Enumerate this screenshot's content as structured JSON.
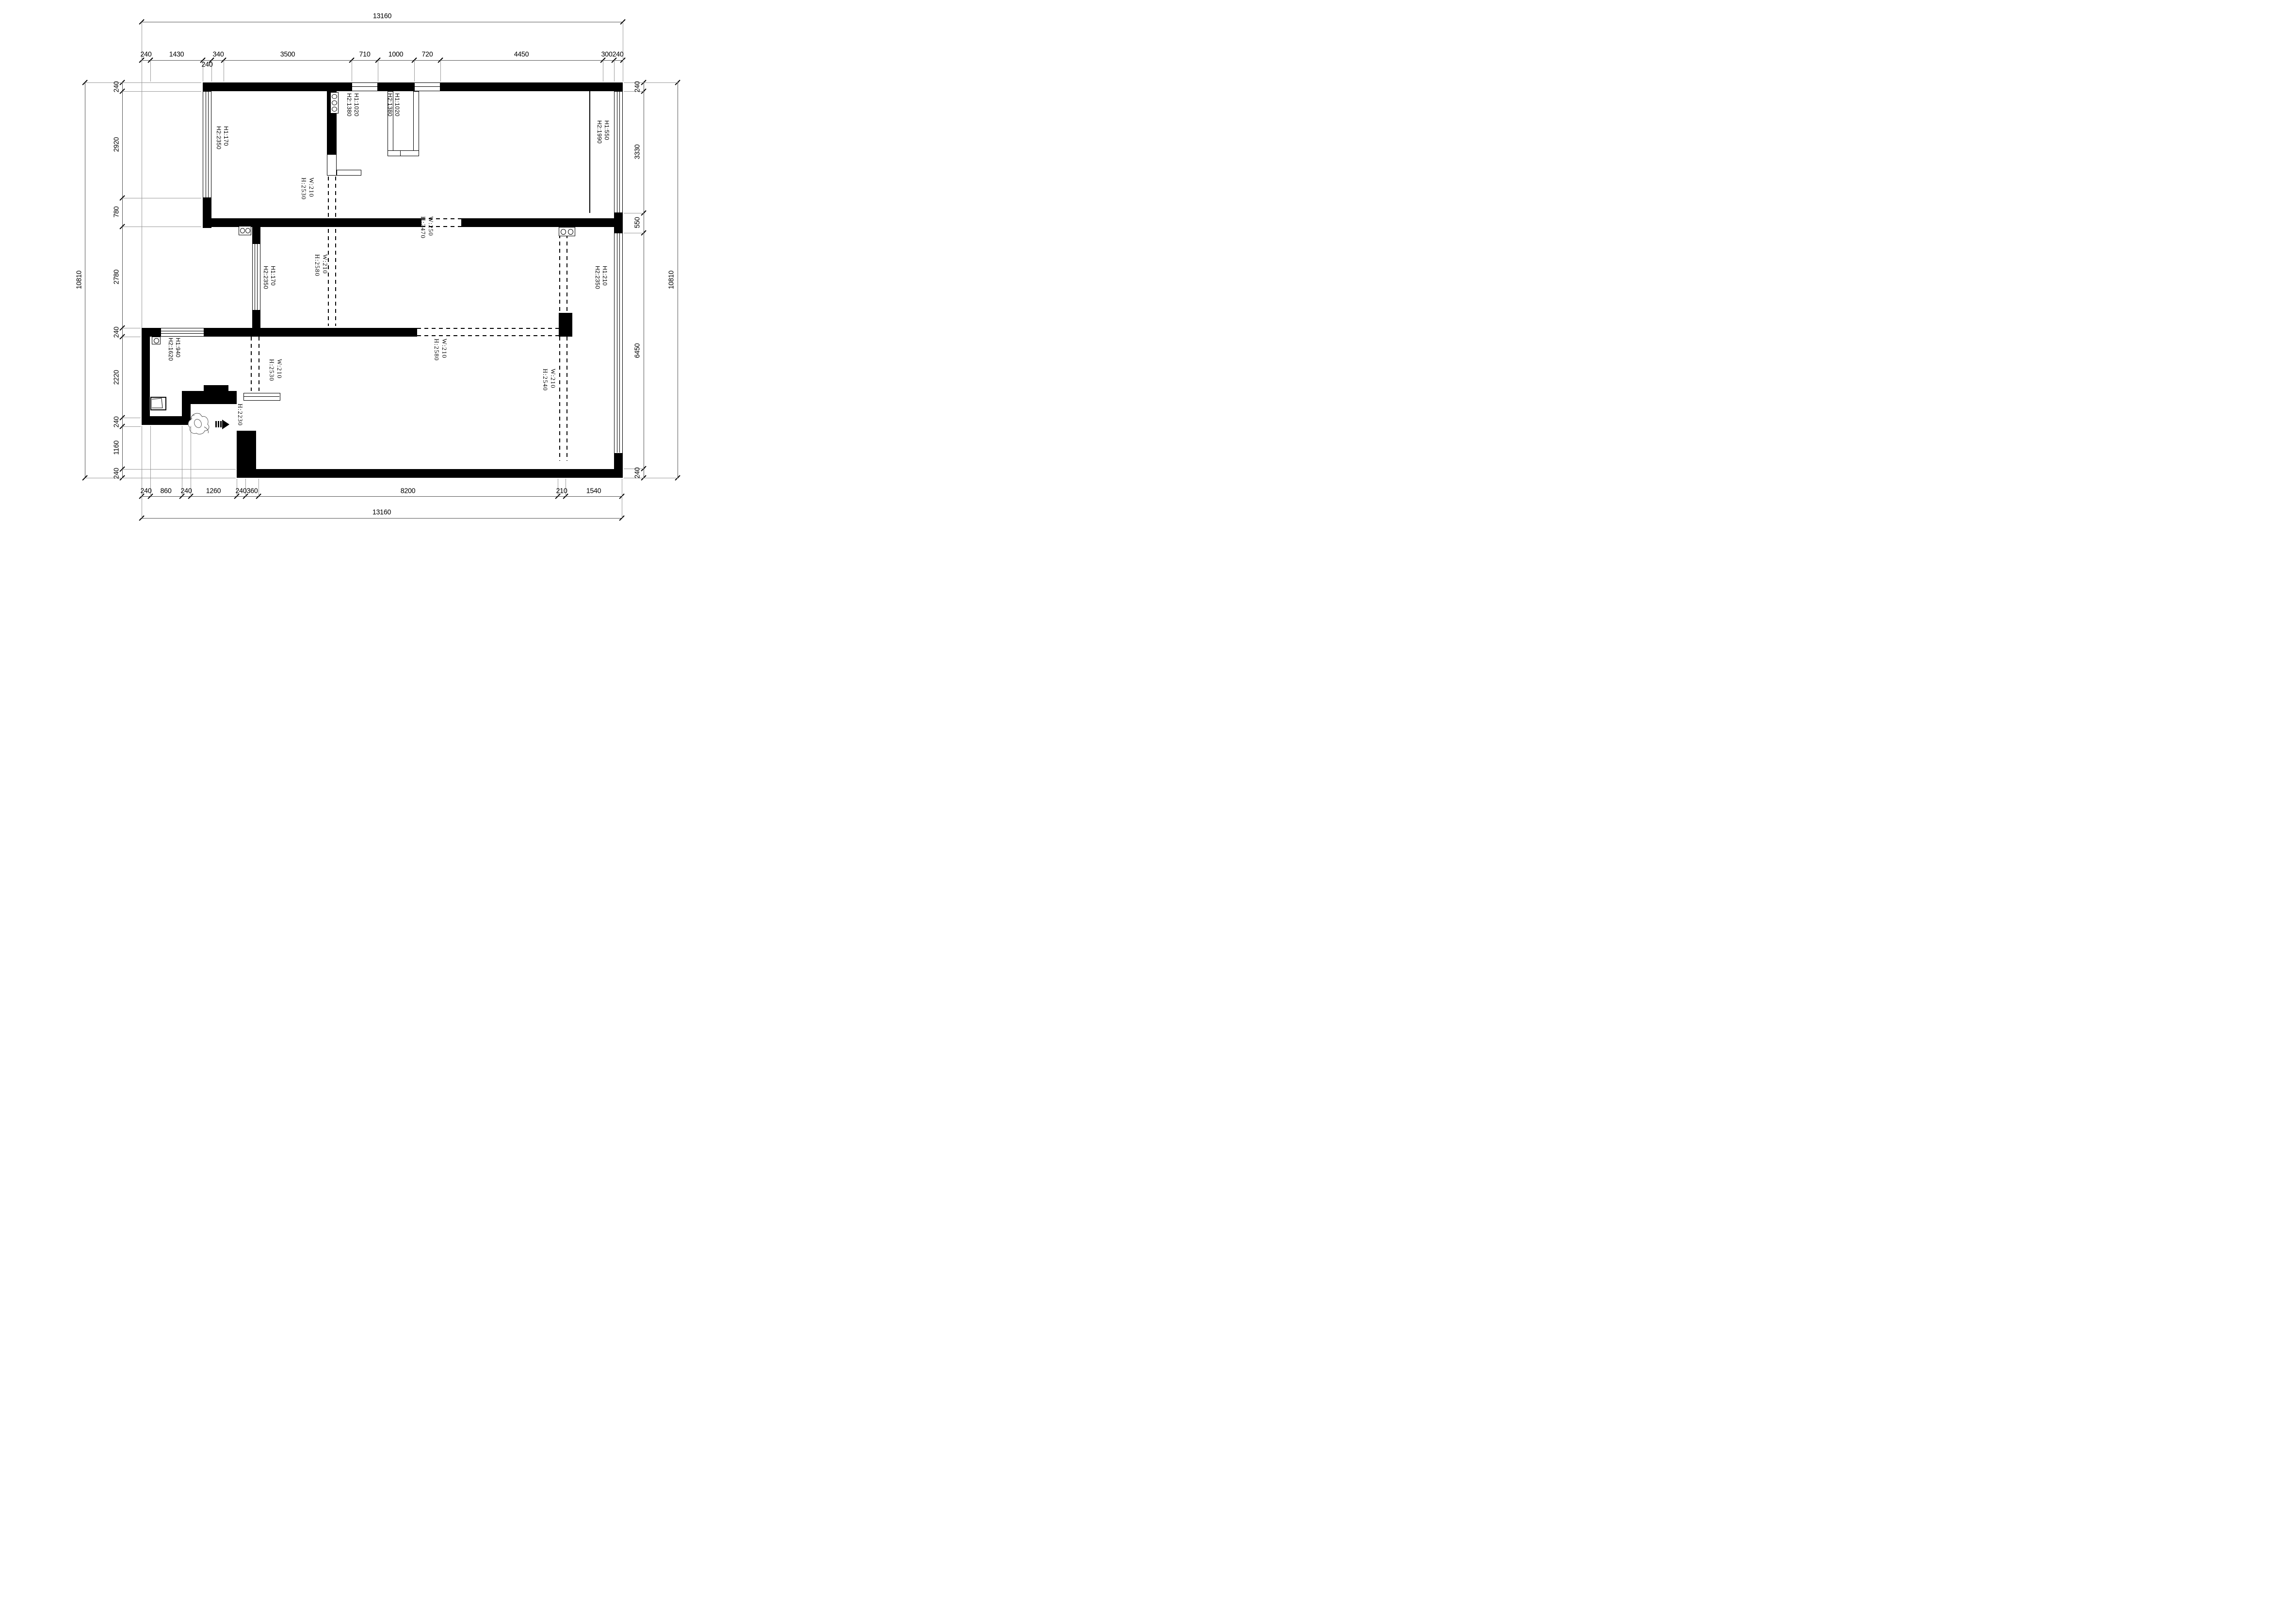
{
  "dims": {
    "top_outer": "13160",
    "top": [
      "240",
      "1430",
      "240",
      "340",
      "3500",
      "710",
      "1000",
      "720",
      "4450",
      "300",
      "240"
    ],
    "left_outer": "10810",
    "left": [
      "240",
      "2920",
      "780",
      "2780",
      "240",
      "2220",
      "240",
      "1160",
      "240"
    ],
    "right": [
      "240",
      "3330",
      "550",
      "6450",
      "240"
    ],
    "right_outer": "10810",
    "bottom": [
      "240",
      "860",
      "240",
      "1260",
      "240",
      "360",
      "8200",
      "210",
      "1540"
    ],
    "bottom_outer": "13160"
  },
  "labels": {
    "win_top1": [
      "H1:1020",
      "H2:1380"
    ],
    "win_top2": [
      "H1:1020",
      "H2:1380"
    ],
    "win_left": [
      "H1:170",
      "H2:2350"
    ],
    "win_right_top": [
      "H1:550",
      "H2:1990"
    ],
    "win_kitchen": [
      "H1:170",
      "H2:2350"
    ],
    "win_right_mid": [
      "H1:210",
      "H2:2350"
    ],
    "win_storage": [
      "H1:940",
      "H2:1620"
    ],
    "door_upper": [
      "W:210",
      "H:2530"
    ],
    "pass_wide": [
      "W:250",
      "H:2470"
    ],
    "door_dining": [
      "W:210",
      "H:2580"
    ],
    "pass_center": [
      "W:210",
      "H:2580"
    ],
    "door_entry": [
      "W:210",
      "H:2530"
    ],
    "door_right": [
      "W:210",
      "H:2540"
    ],
    "entry_height": "H:2230"
  }
}
